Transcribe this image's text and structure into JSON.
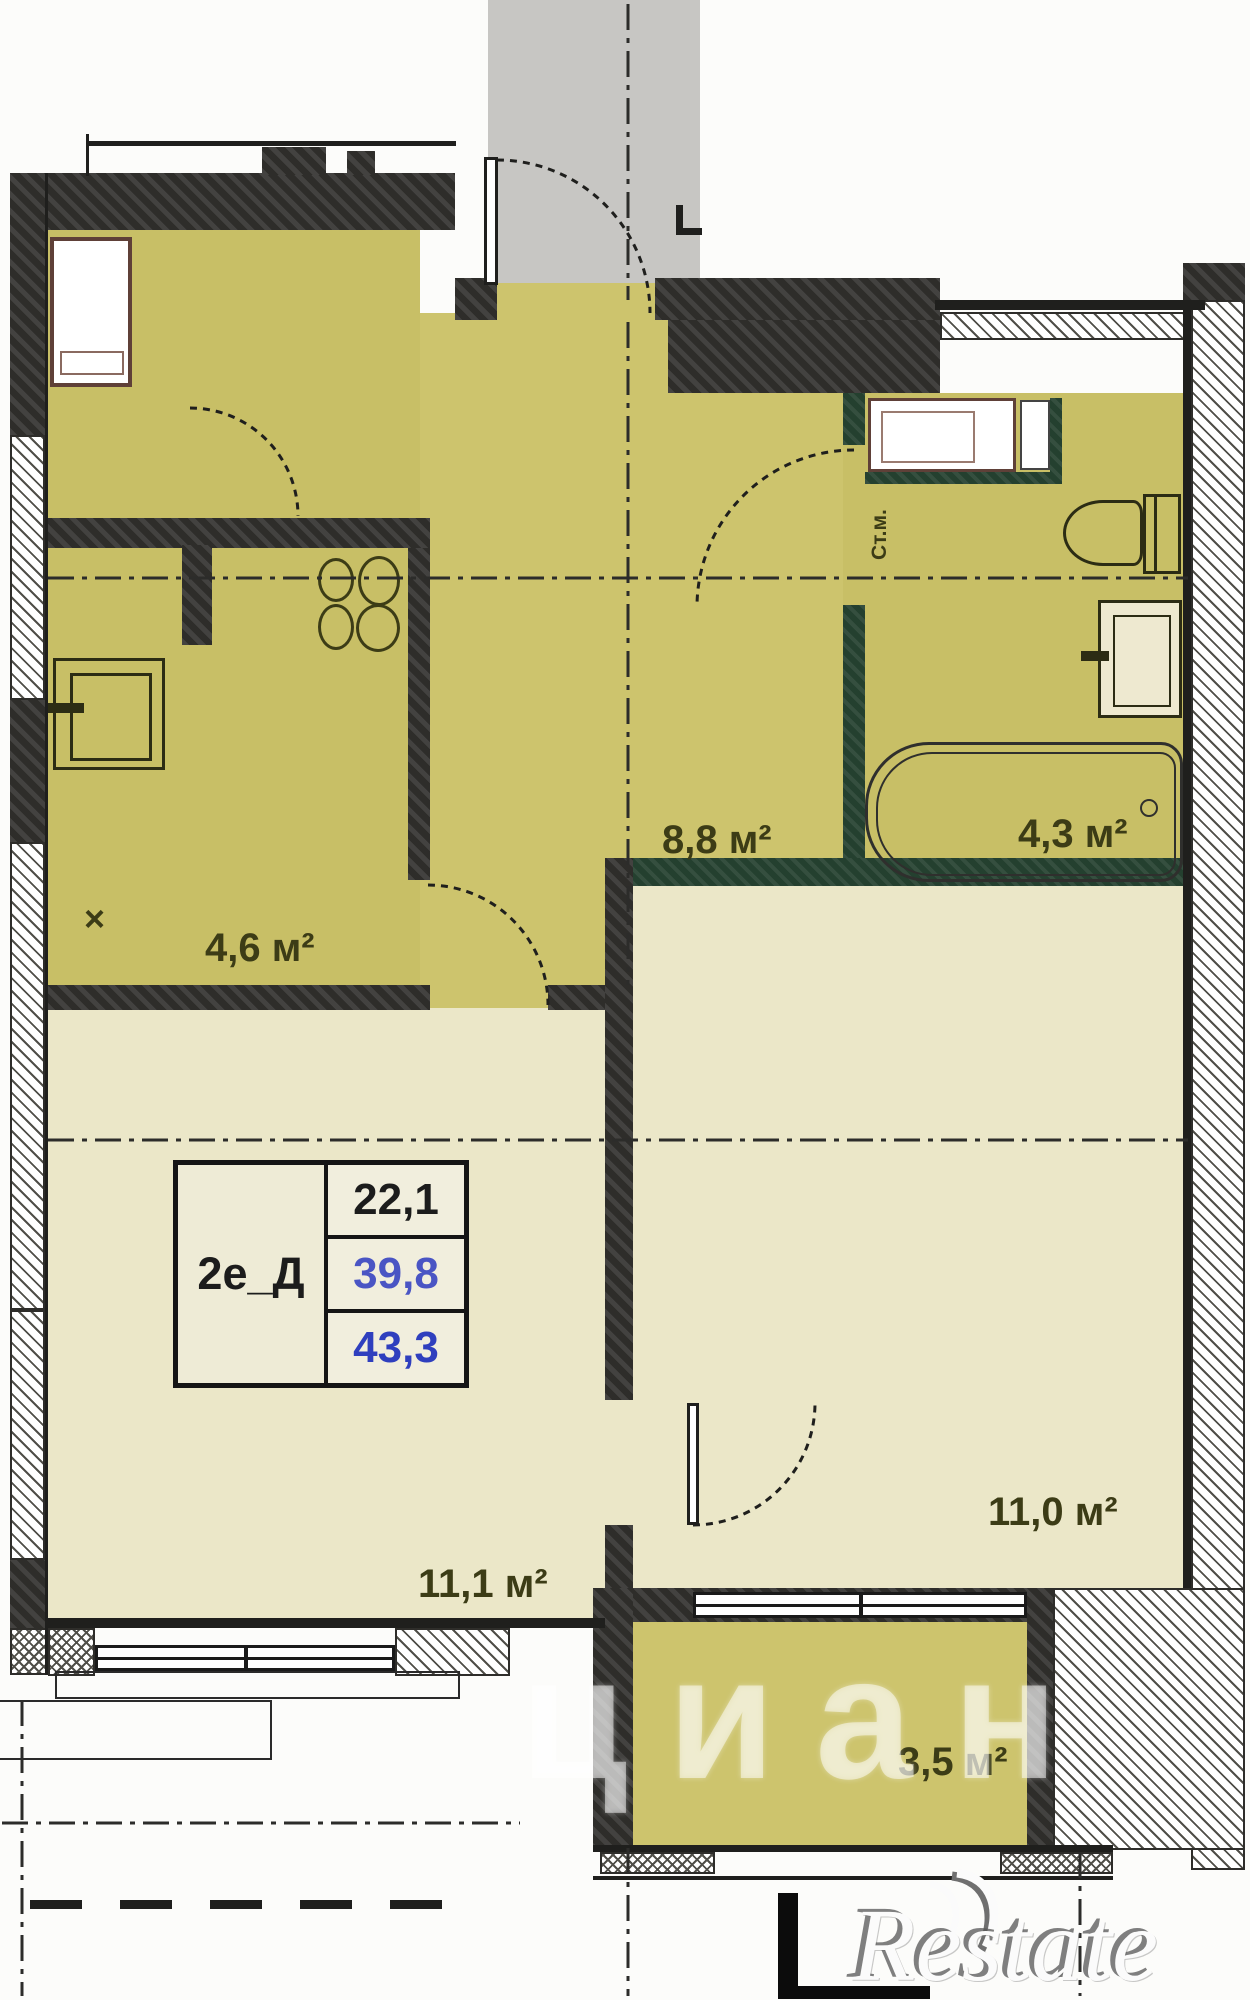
{
  "plan": {
    "title": "apartment floor plan 2е_Д",
    "unit": {
      "type_label": "2е_Д",
      "living_area": "22,1",
      "area_without_balcony": "39,8",
      "total_area": "43,3"
    },
    "rooms": [
      {
        "id": "kitchen-niche",
        "area_label": "4,6 м²"
      },
      {
        "id": "hallway",
        "area_label": "8,8 м²"
      },
      {
        "id": "bathroom",
        "area_label": "4,3 м²"
      },
      {
        "id": "living-room",
        "area_label": "11,1 м²"
      },
      {
        "id": "bedroom",
        "area_label": "11,0 м²"
      },
      {
        "id": "balcony",
        "area_label": "3,5 м²"
      }
    ],
    "labels": {
      "washing_machine": "Ст.м.",
      "vent_marker": "×"
    },
    "watermarks": {
      "cian": "циан",
      "restate": "Restate"
    },
    "colors": {
      "room_khaki": "#cdc46d",
      "room_cream": "#ebe7c8",
      "corridor_gray": "#c7c6c3",
      "wall_dark": "#2e2d2a",
      "wall_green": "#24402f",
      "label_olive": "#3c3c16",
      "value_blue": "#3545c0"
    }
  }
}
